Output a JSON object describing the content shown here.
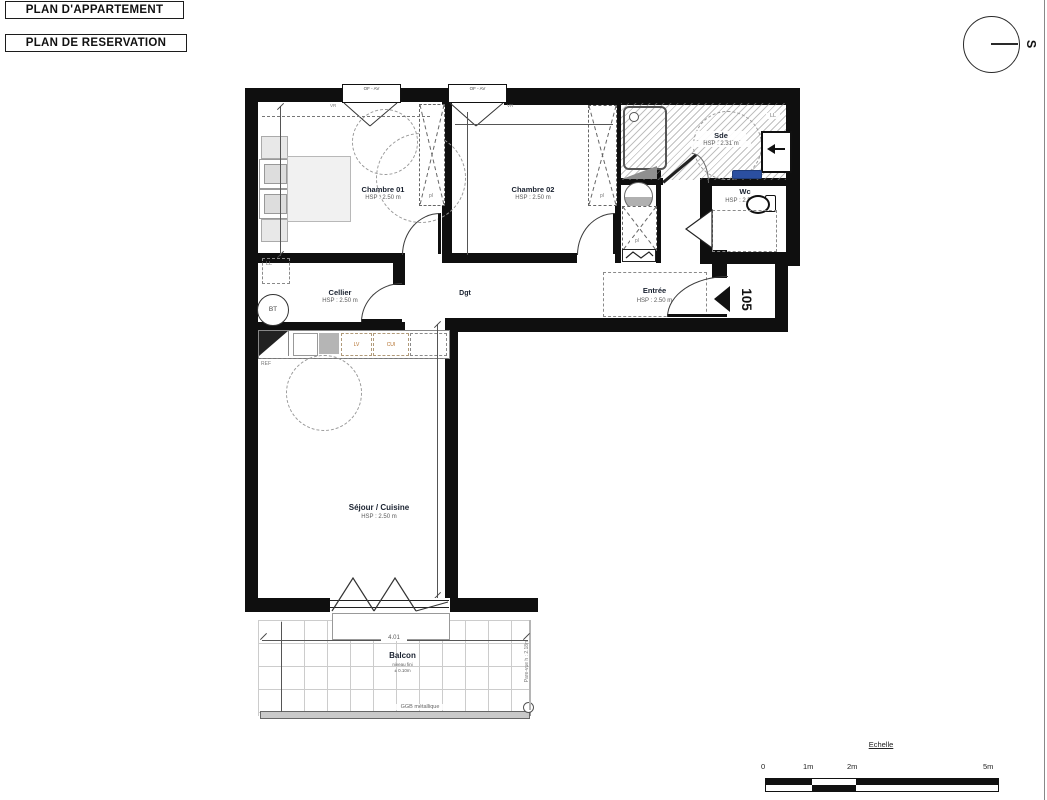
{
  "page": {
    "title1": "PLAN D'APPARTEMENT",
    "title2": "PLAN DE RESERVATION"
  },
  "compass": {
    "south": "S"
  },
  "unit": {
    "number": "105"
  },
  "rooms": {
    "chambre01": {
      "name": "Chambre 01",
      "hsp": "HSP : 2.50 m"
    },
    "chambre02": {
      "name": "Chambre 02",
      "hsp": "HSP : 2.50 m"
    },
    "sde": {
      "name": "Sde",
      "hsp": "HSP : 2.31 m"
    },
    "wc": {
      "name": "Wc",
      "hsp": "HSP : 2.50 m"
    },
    "cellier": {
      "name": "Cellier",
      "hsp": "HSP : 2.50 m"
    },
    "dgt": {
      "name": "Dgt"
    },
    "entree": {
      "name": "Entrée",
      "hsp": "HSP : 2.50 m"
    },
    "sejour": {
      "name": "Séjour / Cuisine",
      "hsp": "HSP : 2.50 m"
    },
    "balcon": {
      "name": "Balcon",
      "note_line1": "niveau fini",
      "note_line2": "± 0.10m"
    }
  },
  "fixtures": {
    "ll": "LL",
    "bt": "BT",
    "lv": "LV",
    "cui": "CUI",
    "ref": "REF",
    "pl": "pl",
    "vr": "VR",
    "window_type": "OF - AV",
    "railing": "GGB métallique",
    "screen": "Pare-vue h : 2.18m"
  },
  "dimensions": {
    "balcony_width": "4.01"
  },
  "scalebar": {
    "title": "Echelle",
    "t0": "0",
    "t1": "1m",
    "t2": "2m",
    "t3": "5m"
  },
  "colors": {
    "accent_blue": "#2b4fa0"
  }
}
